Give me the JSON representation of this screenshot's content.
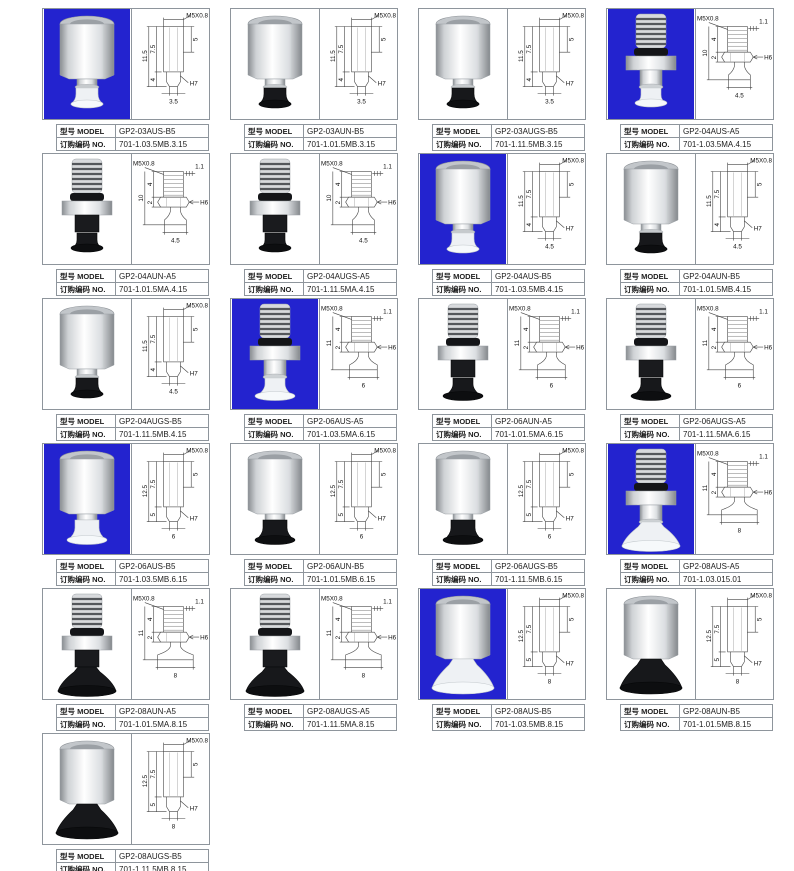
{
  "labels": {
    "model": "型号 MODEL",
    "order": "订购编码 NO."
  },
  "colors": {
    "highlight_bg": "#2323cf",
    "cell_border": "#8e959c",
    "drawing_line": "#454545",
    "cup_black": "#17181b",
    "cup_white": "#eef1f4"
  },
  "grid": {
    "columns": 4
  },
  "items": [
    {
      "model": "GP2-03AUS-B5",
      "order_no": "701-1.03.5MB.3.15",
      "photo": {
        "bg": "blue",
        "body": "hex",
        "cup": "white",
        "size": "s"
      },
      "drawing": {
        "type": "hex",
        "dims": {
          "thread": "M5X0.8",
          "total": "11.5",
          "upper": "7.5",
          "side": "5",
          "lower": "4",
          "fit": "H7",
          "width": "3.5"
        }
      }
    },
    {
      "model": "GP2-03AUN-B5",
      "order_no": "701-1.01.5MB.3.15",
      "photo": {
        "bg": "white",
        "body": "hex",
        "cup": "black",
        "size": "s"
      },
      "drawing": {
        "type": "hex",
        "dims": {
          "thread": "M5X0.8",
          "total": "11.5",
          "upper": "7.5",
          "side": "5",
          "lower": "4",
          "fit": "H7",
          "width": "3.5"
        }
      }
    },
    {
      "model": "GP2-03AUGS-B5",
      "order_no": "701-1.11.5MB.3.15",
      "photo": {
        "bg": "white",
        "body": "hex",
        "cup": "black",
        "size": "s"
      },
      "drawing": {
        "type": "hex",
        "dims": {
          "thread": "M5X0.8",
          "total": "11.5",
          "upper": "7.5",
          "side": "5",
          "lower": "4",
          "fit": "H7",
          "width": "3.5"
        }
      }
    },
    {
      "model": "GP2-04AUS-A5",
      "order_no": "701-1.03.5MA.4.15",
      "photo": {
        "bg": "blue",
        "body": "stud",
        "cup": "white",
        "size": "s"
      },
      "drawing": {
        "type": "stud",
        "dims": {
          "thread": "M5X0.8",
          "pitch": "1.1",
          "t_thread": "4",
          "total": "10",
          "t_nut": "2",
          "fit": "H6",
          "width": "4.5"
        }
      }
    },
    {
      "model": "GP2-04AUN-A5",
      "order_no": "701-1.01.5MA.4.15",
      "photo": {
        "bg": "white",
        "body": "stud",
        "cup": "black",
        "size": "s"
      },
      "drawing": {
        "type": "stud",
        "dims": {
          "thread": "M5X0.8",
          "pitch": "1.1",
          "t_thread": "4",
          "total": "10",
          "t_nut": "2",
          "fit": "H6",
          "width": "4.5"
        }
      }
    },
    {
      "model": "GP2-04AUGS-A5",
      "order_no": "701-1.11.5MA.4.15",
      "photo": {
        "bg": "white",
        "body": "stud",
        "cup": "black",
        "size": "s"
      },
      "drawing": {
        "type": "stud",
        "dims": {
          "thread": "M5X0.8",
          "pitch": "1.1",
          "t_thread": "4",
          "total": "10",
          "t_nut": "2",
          "fit": "H6",
          "width": "4.5"
        }
      }
    },
    {
      "model": "GP2-04AUS-B5",
      "order_no": "701-1.03.5MB.4.15",
      "photo": {
        "bg": "blue",
        "body": "hex",
        "cup": "white",
        "size": "s"
      },
      "drawing": {
        "type": "hex",
        "dims": {
          "thread": "M5X0.8",
          "total": "11.5",
          "upper": "7.5",
          "side": "5",
          "lower": "4",
          "fit": "H7",
          "width": "4.5"
        }
      }
    },
    {
      "model": "GP2-04AUN-B5",
      "order_no": "701-1.01.5MB.4.15",
      "photo": {
        "bg": "white",
        "body": "hex",
        "cup": "black",
        "size": "s"
      },
      "drawing": {
        "type": "hex",
        "dims": {
          "thread": "M5X0.8",
          "total": "11.5",
          "upper": "7.5",
          "side": "5",
          "lower": "4",
          "fit": "H7",
          "width": "4.5"
        }
      }
    },
    {
      "model": "GP2-04AUGS-B5",
      "order_no": "701-1.11.5MB.4.15",
      "photo": {
        "bg": "white",
        "body": "hex",
        "cup": "black",
        "size": "s"
      },
      "drawing": {
        "type": "hex",
        "dims": {
          "thread": "M5X0.8",
          "total": "11.5",
          "upper": "7.5",
          "side": "5",
          "lower": "4",
          "fit": "H7",
          "width": "4.5"
        }
      }
    },
    {
      "model": "GP2-06AUS-A5",
      "order_no": "701-1.03.5MA.6.15",
      "photo": {
        "bg": "blue",
        "body": "stud",
        "cup": "white",
        "size": "m"
      },
      "drawing": {
        "type": "stud",
        "dims": {
          "thread": "M5X0.8",
          "pitch": "1.1",
          "t_thread": "4",
          "total": "11",
          "t_nut": "2",
          "fit": "H6",
          "width": "6"
        }
      }
    },
    {
      "model": "GP2-06AUN-A5",
      "order_no": "701-1.01.5MA.6.15",
      "photo": {
        "bg": "white",
        "body": "stud",
        "cup": "black",
        "size": "m"
      },
      "drawing": {
        "type": "stud",
        "dims": {
          "thread": "M5X0.8",
          "pitch": "1.1",
          "t_thread": "4",
          "total": "11",
          "t_nut": "2",
          "fit": "H6",
          "width": "6"
        }
      }
    },
    {
      "model": "GP2-06AUGS-A5",
      "order_no": "701-1.11.5MA.6.15",
      "photo": {
        "bg": "white",
        "body": "stud",
        "cup": "black",
        "size": "m"
      },
      "drawing": {
        "type": "stud",
        "dims": {
          "thread": "M5X0.8",
          "pitch": "1.1",
          "t_thread": "4",
          "total": "11",
          "t_nut": "2",
          "fit": "H6",
          "width": "6"
        }
      }
    },
    {
      "model": "GP2-06AUS-B5",
      "order_no": "701-1.03.5MB.6.15",
      "photo": {
        "bg": "blue",
        "body": "hex",
        "cup": "white",
        "size": "m"
      },
      "drawing": {
        "type": "hex",
        "dims": {
          "thread": "M5X0.8",
          "total": "12.5",
          "upper": "7.5",
          "side": "5",
          "lower": "5",
          "fit": "H7",
          "width": "6"
        }
      }
    },
    {
      "model": "GP2-06AUN-B5",
      "order_no": "701-1.01.5MB.6.15",
      "photo": {
        "bg": "white",
        "body": "hex",
        "cup": "black",
        "size": "m"
      },
      "drawing": {
        "type": "hex",
        "dims": {
          "thread": "M5X0.8",
          "total": "12.5",
          "upper": "7.5",
          "side": "5",
          "lower": "5",
          "fit": "H7",
          "width": "6"
        }
      }
    },
    {
      "model": "GP2-06AUGS-B5",
      "order_no": "701-1.11.5MB.6.15",
      "photo": {
        "bg": "white",
        "body": "hex",
        "cup": "black",
        "size": "m"
      },
      "drawing": {
        "type": "hex",
        "dims": {
          "thread": "M5X0.8",
          "total": "12.5",
          "upper": "7.5",
          "side": "5",
          "lower": "5",
          "fit": "H7",
          "width": "6"
        }
      }
    },
    {
      "model": "GP2-08AUS-A5",
      "order_no": "701-1.03.015.01",
      "photo": {
        "bg": "blue",
        "body": "stud",
        "cup": "white",
        "size": "w"
      },
      "drawing": {
        "type": "stud",
        "dims": {
          "thread": "M5X0.8",
          "pitch": "1.1",
          "t_thread": "4",
          "total": "11",
          "t_nut": "2",
          "fit": "H6",
          "width": "8"
        }
      }
    },
    {
      "model": "GP2-08AUN-A5",
      "order_no": "701-1.01.5MA.8.15",
      "photo": {
        "bg": "white",
        "body": "stud",
        "cup": "black",
        "size": "w"
      },
      "drawing": {
        "type": "stud",
        "dims": {
          "thread": "M5X0.8",
          "pitch": "1.1",
          "t_thread": "4",
          "total": "11",
          "t_nut": "2",
          "fit": "H6",
          "width": "8"
        }
      }
    },
    {
      "model": "GP2-08AUGS-A5",
      "order_no": "701-1.11.5MA.8.15",
      "photo": {
        "bg": "white",
        "body": "stud",
        "cup": "black",
        "size": "w"
      },
      "drawing": {
        "type": "stud",
        "dims": {
          "thread": "M5X0.8",
          "pitch": "1.1",
          "t_thread": "4",
          "total": "11",
          "t_nut": "2",
          "fit": "H6",
          "width": "8"
        }
      }
    },
    {
      "model": "GP2-08AUS-B5",
      "order_no": "701-1.03.5MB.8.15",
      "photo": {
        "bg": "blue",
        "body": "hex",
        "cup": "white",
        "size": "w"
      },
      "drawing": {
        "type": "hex",
        "dims": {
          "thread": "M5X0.8",
          "total": "12.5",
          "upper": "7.5",
          "side": "5",
          "lower": "5",
          "fit": "H7",
          "width": "8"
        }
      }
    },
    {
      "model": "GP2-08AUN-B5",
      "order_no": "701-1.01.5MB.8.15",
      "photo": {
        "bg": "white",
        "body": "hex",
        "cup": "black",
        "size": "w"
      },
      "drawing": {
        "type": "hex",
        "dims": {
          "thread": "M5X0.8",
          "total": "12.5",
          "upper": "7.5",
          "side": "5",
          "lower": "5",
          "fit": "H7",
          "width": "8"
        }
      }
    },
    {
      "model": "GP2-08AUGS-B5",
      "order_no": "701-1.11.5MB.8.15",
      "photo": {
        "bg": "white",
        "body": "hex",
        "cup": "black",
        "size": "w"
      },
      "drawing": {
        "type": "hex",
        "dims": {
          "thread": "M5X0.8",
          "total": "12.5",
          "upper": "7.5",
          "side": "5",
          "lower": "5",
          "fit": "H7",
          "width": "8"
        }
      }
    }
  ]
}
